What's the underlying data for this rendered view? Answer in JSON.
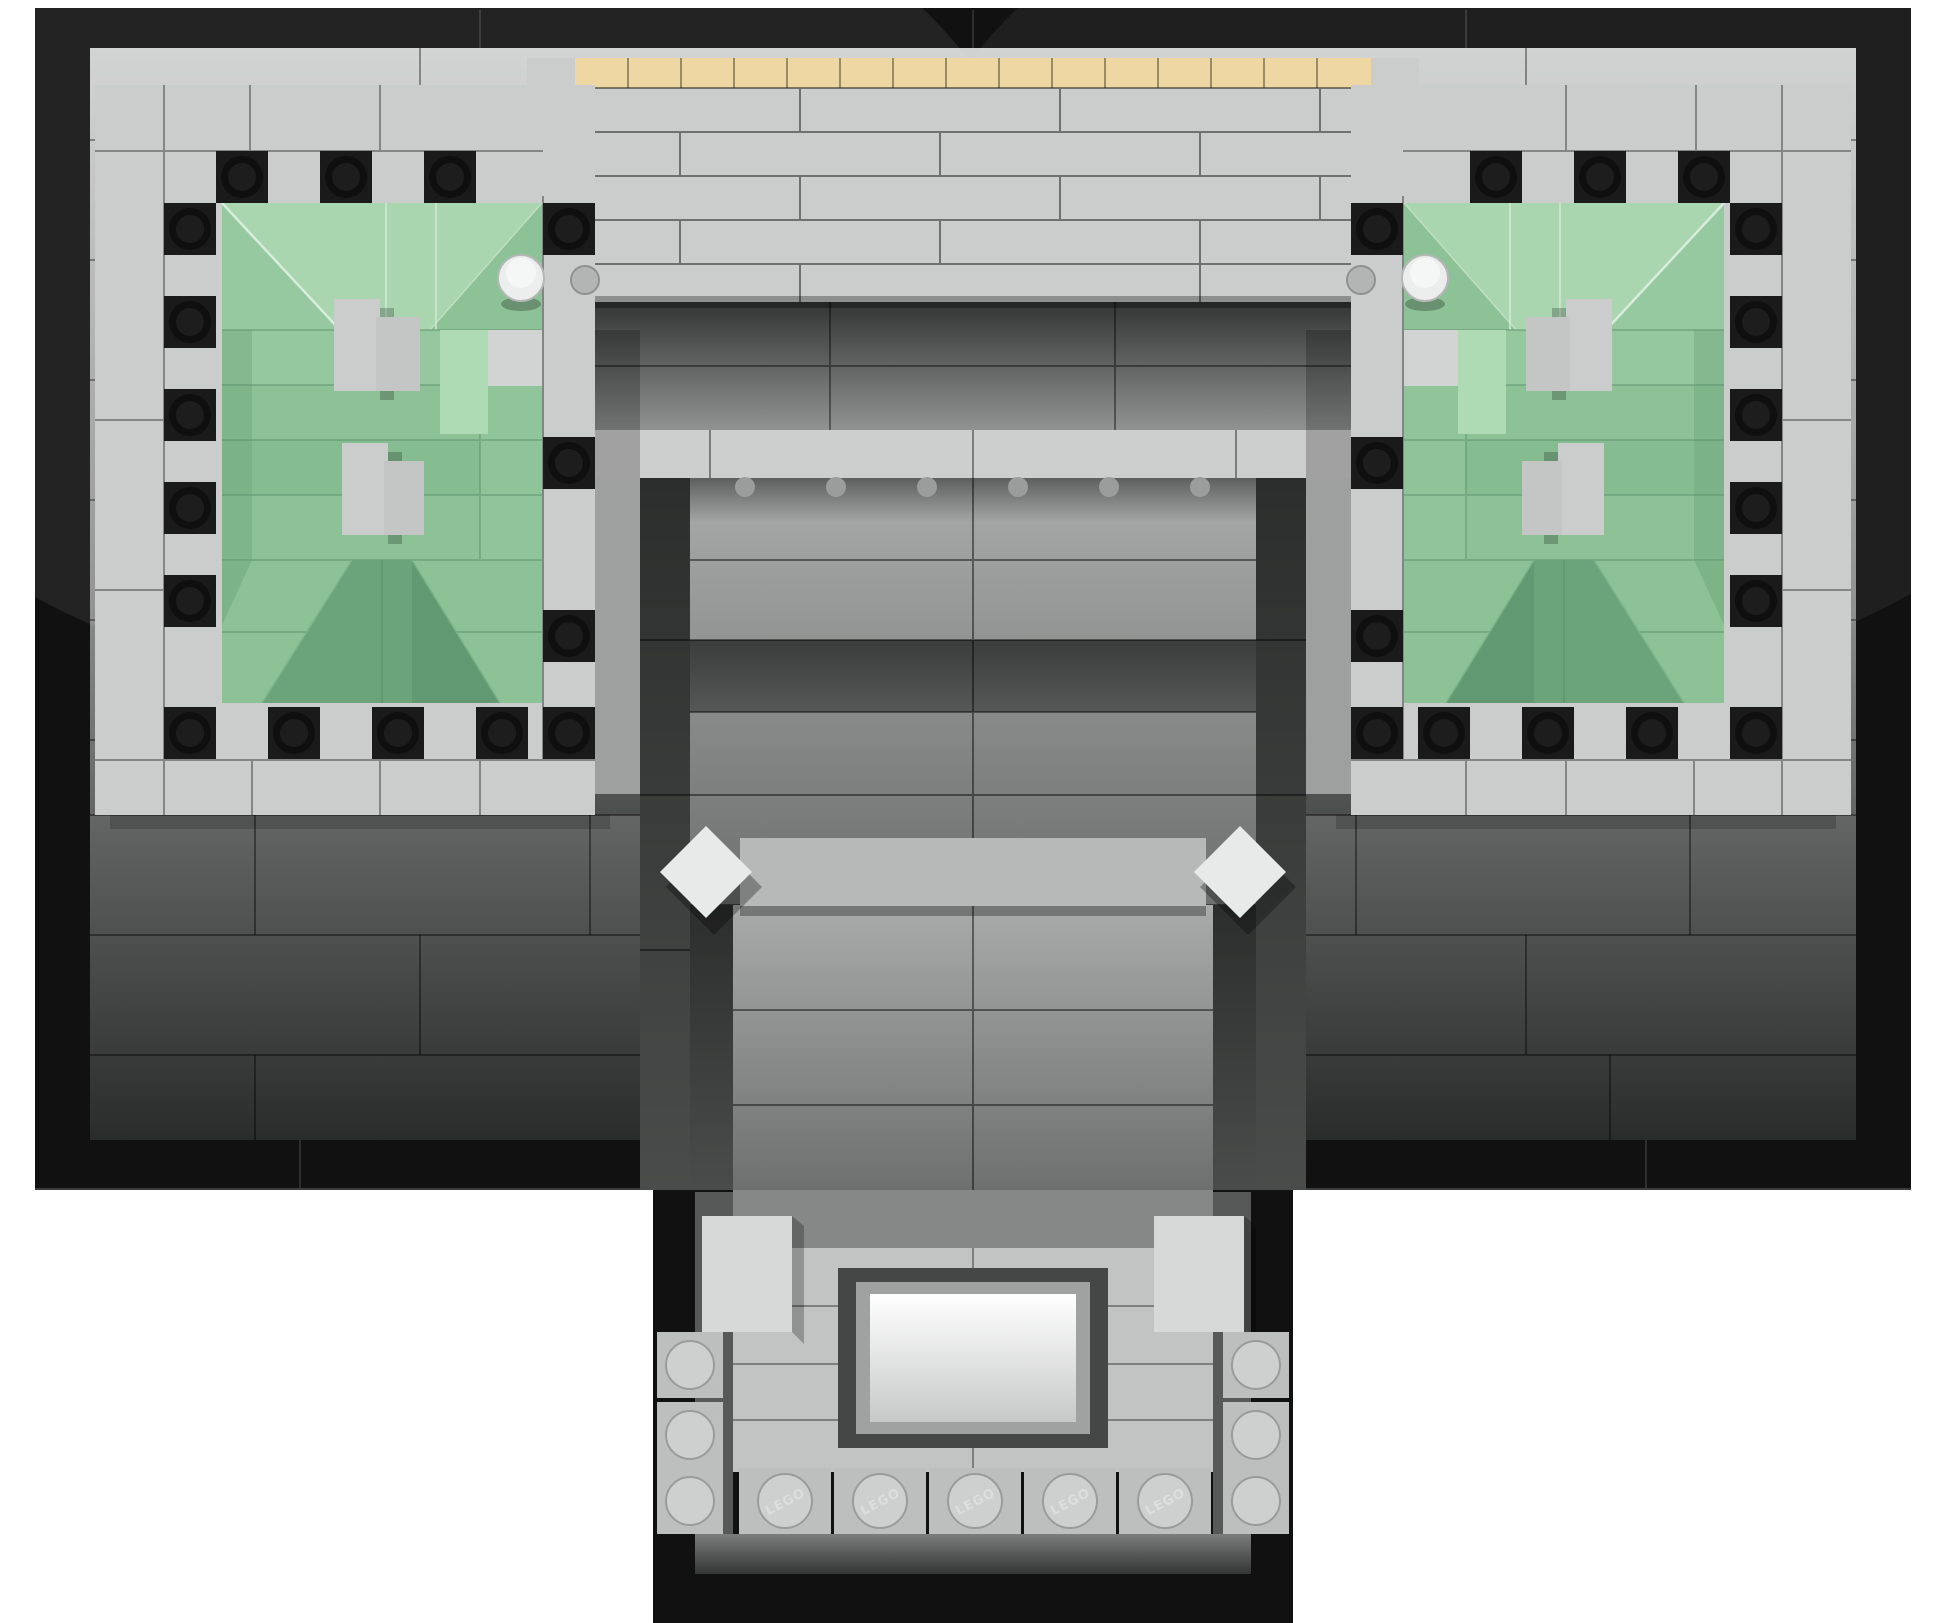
{
  "scene": {
    "subject": "Top-down aerial view of a LEGO Architecture style building model on a white background",
    "background": "#ffffff",
    "stud_embossing": "LEGO"
  },
  "palette": {
    "black": "#111111",
    "black_tile": "#1a1a1a",
    "seam": "#000000",
    "lt_gray": "#cbcdcc",
    "frame_gray": "#d7d9d8",
    "lt_gray_lo": "#b3b5b4",
    "ground_hi": "#d0d2d1",
    "ground_mid": "#8b8d8c",
    "ground_lo": "#2a2c2b",
    "tan": "#eed7a2",
    "white_piece": "#eceeed",
    "cyl_small": "#b3b5b4",
    "green_light": "#a9d5af",
    "green_mid": "#8cc295",
    "green_row": "#96c99f",
    "green_dark": "#6ba37a",
    "green_deep": "#5d9570",
    "green_seam": "#5b8f6b",
    "recess_hi": "#919392",
    "recess_lo": "#333534",
    "bar_light": "#cdcfce",
    "nave_hi": "#a9abaa",
    "nave_lo": "#6e706f",
    "band_hi": "#565857",
    "band_lo": "#3b3d3c",
    "dark_strip_hi": "#4a4c4b",
    "dark_strip_lo": "#2c2e2d",
    "bar_gray": "#b7b9b8",
    "diamond": "#e8eae9",
    "diamond_edge": "#9fa1a0",
    "bump": "#9b9d9c",
    "bevel": "#575958",
    "porch_silver": "#868887",
    "floor_gray": "#c2c4c3",
    "chamber_frame": "#454746",
    "chamber_lip": "#a0a2a1",
    "chamber_hi": "#ffffff",
    "chamber_lo": "#c7c9c8",
    "stud_cell": "#bdbfbe",
    "stud_face": "#ced0cf",
    "strip_hi": "#7c7e7d",
    "strip_lo": "#333534",
    "chimney": "#cbcdcc",
    "chimney_dark": "#c4c6c5"
  },
  "model": {
    "baseplate_color_name": "black",
    "pavilions": {
      "count": 2,
      "roof_color_name": "sand green",
      "border_stud_tiles_per_pavilion": 16,
      "chimney_blocks_per_pavilion": 2
    },
    "central_building": {
      "tan_tile_count": 15,
      "white_cylinder_count": 2,
      "small_cylinder_count": 2,
      "diamond_tile_count": 2,
      "ridge_stud_bumps": 6
    },
    "portico": {
      "pillar_count": 2,
      "bottom_stud_count": 5,
      "side_stud_count": 4,
      "corner_stud_count": 2
    }
  }
}
